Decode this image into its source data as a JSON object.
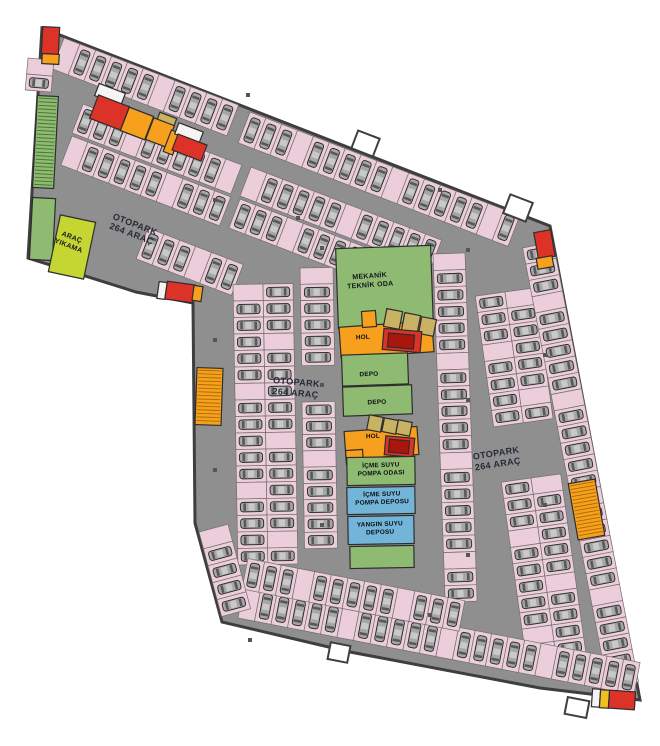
{
  "labels": {
    "otopark_wing": {
      "line1": "OTOPARK",
      "line2": "264 ARAÇ"
    },
    "otopark_left": {
      "line1": "OTOPARK",
      "line2": "264 ARAÇ"
    },
    "otopark_right": {
      "line1": "OTOPARK",
      "line2": "264 ARAÇ"
    },
    "arac_yikama": {
      "line1": "ARAÇ",
      "line2": "YIKAMA"
    },
    "mekanik": {
      "line1": "MEKANİK",
      "line2": "TEKNİK ODA"
    },
    "hol_upper": "HOL",
    "hol_lower": "HOL",
    "depo_1": "DEPO",
    "depo_2": "DEPO",
    "icme_odasi": {
      "line1": "İÇME SUYU",
      "line2": "POMPA ODASI"
    },
    "icme_deposu": {
      "line1": "İÇME SUYU",
      "line2": "POMPA DEPOSU"
    },
    "yangin": {
      "line1": "YANGIN SUYU",
      "line2": "DEPOSU"
    }
  },
  "colors": {
    "floor": "#8f8f8f",
    "outside": "#ffffff",
    "wall": "#3e3e3e",
    "stall": "#eccdda",
    "stall_stroke": "#6f6f6f",
    "car": "#a6a6a6",
    "car_stroke": "#262626",
    "car_glass": "#585858",
    "car_roof": "#c9c9c9",
    "green": "#8eba72",
    "hatch_green": "#47702f",
    "orange": "#f6a01e",
    "hatch_orange": "#a96a00",
    "red": "#dd3227",
    "red_dark": "#a8160e",
    "tan": "#c9b264",
    "blue": "#72b5d8",
    "carwash": "#c5d633",
    "yellow": "#f0c020",
    "white": "#f4f4f4",
    "pillar": "#565656"
  },
  "outline": "42,28 550,226 640,700 540,688 350,652 222,622 195,523 193,303 136,292 28,258",
  "rooms": [
    {
      "n": "stair-core-topleft-red",
      "x": 42,
      "y": 27,
      "w": 17,
      "h": 27,
      "f": "red",
      "r": 3
    },
    {
      "n": "stair-core-topleft-orange",
      "x": 42,
      "y": 54,
      "w": 17,
      "h": 10,
      "f": "orange",
      "r": 3
    },
    {
      "n": "stairs-left-upper",
      "x": 35,
      "y": 96,
      "w": 21,
      "h": 92,
      "f": "green",
      "r": 3,
      "hatch": "g"
    },
    {
      "n": "stairs-left-lower",
      "x": 31,
      "y": 198,
      "w": 23,
      "h": 62,
      "f": "green",
      "r": 3
    },
    {
      "n": "carwash-room",
      "x": 54,
      "y": 218,
      "w": 36,
      "h": 58,
      "f": "carwash",
      "r": 12
    },
    {
      "n": "wing-core-white-a",
      "x": 96,
      "y": 88,
      "w": 28,
      "h": 13,
      "f": "white",
      "r": 21
    },
    {
      "n": "wing-core-red-a",
      "x": 93,
      "y": 100,
      "w": 33,
      "h": 25,
      "f": "red",
      "r": 21
    },
    {
      "n": "wing-core-orange-a",
      "x": 124,
      "y": 111,
      "w": 26,
      "h": 25,
      "f": "orange",
      "r": 21
    },
    {
      "n": "wing-core-tan-a",
      "x": 157,
      "y": 115,
      "w": 18,
      "h": 13,
      "f": "tan",
      "r": 21
    },
    {
      "n": "wing-core-orange-b",
      "x": 149,
      "y": 121,
      "w": 22,
      "h": 23,
      "f": "orange",
      "r": 21
    },
    {
      "n": "wing-core-orange-strip",
      "x": 167,
      "y": 131,
      "w": 10,
      "h": 23,
      "f": "orange",
      "r": 21
    },
    {
      "n": "wing-core-white-b",
      "x": 176,
      "y": 127,
      "w": 26,
      "h": 12,
      "f": "white",
      "r": 21
    },
    {
      "n": "wing-core-red-b",
      "x": 174,
      "y": 139,
      "w": 31,
      "h": 17,
      "f": "red",
      "r": 21
    },
    {
      "n": "stair-core-west-white",
      "x": 158,
      "y": 282,
      "w": 8,
      "h": 17,
      "f": "white",
      "r": 8
    },
    {
      "n": "stair-core-west-red",
      "x": 166,
      "y": 283,
      "w": 28,
      "h": 18,
      "f": "red",
      "r": 8
    },
    {
      "n": "stair-core-west-orange",
      "x": 193,
      "y": 286,
      "w": 9,
      "h": 15,
      "f": "orange",
      "r": 8
    },
    {
      "n": "mekanik-room",
      "x": 337,
      "y": 247,
      "w": 95,
      "h": 80,
      "f": "green",
      "r": -2
    },
    {
      "n": "hol-upper-area",
      "x": 340,
      "y": 324,
      "w": 93,
      "h": 31,
      "f": "orange",
      "r": -4
    },
    {
      "n": "hol-upper-stub",
      "x": 362,
      "y": 311,
      "w": 14,
      "h": 16,
      "f": "orange",
      "r": -4
    },
    {
      "n": "tan-room-1a",
      "x": 385,
      "y": 310,
      "w": 16,
      "h": 18,
      "f": "tan",
      "r": 11
    },
    {
      "n": "tan-room-1b",
      "x": 403,
      "y": 314,
      "w": 16,
      "h": 18,
      "f": "tan",
      "r": 11
    },
    {
      "n": "tan-room-1c",
      "x": 420,
      "y": 318,
      "w": 15,
      "h": 17,
      "f": "tan",
      "r": 11
    },
    {
      "n": "elevator-upper-red",
      "x": 383,
      "y": 330,
      "w": 38,
      "h": 21,
      "f": "red",
      "r": 5
    },
    {
      "n": "elevator-upper-inner",
      "x": 388,
      "y": 334,
      "w": 26,
      "h": 14,
      "f": "red_dark",
      "r": 5
    },
    {
      "n": "depo1-room",
      "x": 342,
      "y": 354,
      "w": 66,
      "h": 31,
      "f": "green",
      "r": -2
    },
    {
      "n": "depo2-room",
      "x": 343,
      "y": 386,
      "w": 69,
      "h": 29,
      "f": "green",
      "r": -2
    },
    {
      "n": "hol-lower-area",
      "x": 345,
      "y": 429,
      "w": 73,
      "h": 28,
      "f": "orange",
      "r": -4
    },
    {
      "n": "hol-lower-stub",
      "x": 346,
      "y": 450,
      "w": 17,
      "h": 14,
      "f": "orange",
      "r": -4
    },
    {
      "n": "tan-room-2a",
      "x": 368,
      "y": 416,
      "w": 14,
      "h": 15,
      "f": "tan",
      "r": 11
    },
    {
      "n": "tan-room-2b",
      "x": 383,
      "y": 419,
      "w": 14,
      "h": 14,
      "f": "tan",
      "r": 11
    },
    {
      "n": "tan-room-2c",
      "x": 397,
      "y": 421,
      "w": 14,
      "h": 14,
      "f": "tan",
      "r": 11
    },
    {
      "n": "elevator-lower-red",
      "x": 385,
      "y": 437,
      "w": 29,
      "h": 19,
      "f": "red",
      "r": 5
    },
    {
      "n": "elevator-lower-inner",
      "x": 389,
      "y": 440,
      "w": 20,
      "h": 13,
      "f": "red_dark",
      "r": 5
    },
    {
      "n": "icme-odasi-room",
      "x": 347,
      "y": 457,
      "w": 68,
      "h": 28,
      "f": "green",
      "r": -1
    },
    {
      "n": "icme-deposu-room",
      "x": 347,
      "y": 487,
      "w": 68,
      "h": 27,
      "f": "blue",
      "r": -1
    },
    {
      "n": "yangin-deposu-room",
      "x": 348,
      "y": 516,
      "w": 66,
      "h": 28,
      "f": "blue",
      "r": -1
    },
    {
      "n": "south-green-room",
      "x": 350,
      "y": 546,
      "w": 64,
      "h": 22,
      "f": "green",
      "r": -1
    },
    {
      "n": "stair-core-topright-red",
      "x": 536,
      "y": 231,
      "w": 17,
      "h": 27,
      "f": "red",
      "r": -10
    },
    {
      "n": "stair-core-topright-orange",
      "x": 537,
      "y": 257,
      "w": 16,
      "h": 11,
      "f": "orange",
      "r": -10
    },
    {
      "n": "ramp-west",
      "x": 196,
      "y": 368,
      "w": 26,
      "h": 57,
      "f": "orange",
      "r": 2,
      "hatch": "o"
    },
    {
      "n": "ramp-east",
      "x": 573,
      "y": 481,
      "w": 27,
      "h": 57,
      "f": "orange",
      "r": -10,
      "hatch": "o"
    },
    {
      "n": "stair-core-bottomright-white",
      "x": 592,
      "y": 689,
      "w": 8,
      "h": 18,
      "f": "white",
      "r": 4
    },
    {
      "n": "stair-core-bottomright-yellow",
      "x": 600,
      "y": 690,
      "w": 9,
      "h": 18,
      "f": "yellow",
      "r": 4
    },
    {
      "n": "stair-core-bottomright-red",
      "x": 609,
      "y": 691,
      "w": 26,
      "h": 18,
      "f": "red",
      "r": 4
    },
    {
      "n": "vent-notch-top-1",
      "x": 354,
      "y": 134,
      "w": 23,
      "h": 19,
      "f": "outside",
      "r": 21,
      "s": "wall"
    },
    {
      "n": "vent-notch-top-2",
      "x": 506,
      "y": 198,
      "w": 24,
      "h": 20,
      "f": "outside",
      "r": 21,
      "s": "wall"
    },
    {
      "n": "vent-notch-bottom-1",
      "x": 329,
      "y": 644,
      "w": 20,
      "h": 17,
      "f": "outside",
      "r": 11,
      "s": "wall"
    },
    {
      "n": "vent-notch-bottom-2",
      "x": 566,
      "y": 699,
      "w": 22,
      "h": 17,
      "f": "outside",
      "r": 11,
      "s": "wall"
    }
  ],
  "parking_rows": [
    {
      "n": "wing-top-row",
      "x": 64,
      "y": 38,
      "a": 21,
      "c": 11,
      "w": 17,
      "d": 33,
      "s": 1
    },
    {
      "n": "wing-mid-row-upper",
      "x": 72,
      "y": 133,
      "a": 21,
      "c": 10,
      "w": 17,
      "d": 31,
      "s": -1
    },
    {
      "n": "wing-mid-row-lower",
      "x": 72,
      "y": 136,
      "a": 21,
      "c": 10,
      "w": 17,
      "d": 31,
      "s": 1
    },
    {
      "n": "wing-bottom-row",
      "x": 148,
      "y": 228,
      "a": 21,
      "c": 6,
      "w": 17,
      "d": 33,
      "s": 1
    },
    {
      "n": "wing-left-row",
      "x": 28,
      "y": 58,
      "a": 95,
      "c": 2,
      "w": 16,
      "d": 26,
      "s": -1
    },
    {
      "n": "north-edge-row",
      "x": 250,
      "y": 112,
      "a": 21,
      "c": 17,
      "w": 17,
      "d": 33,
      "s": 1
    },
    {
      "n": "north-mid-row-upper",
      "x": 240,
      "y": 196,
      "a": 21,
      "c": 12,
      "w": 17,
      "d": 31,
      "s": -1
    },
    {
      "n": "north-mid-row-lower",
      "x": 240,
      "y": 199,
      "a": 21,
      "c": 12,
      "w": 17,
      "d": 31,
      "s": 1
    },
    {
      "n": "west-col-left",
      "x": 263,
      "y": 284,
      "a": 89,
      "c": 17,
      "w": 16.5,
      "d": 30,
      "s": 1
    },
    {
      "n": "west-col-right",
      "x": 263,
      "y": 284,
      "a": 89,
      "c": 17,
      "w": 16.5,
      "d": 30,
      "s": -1
    },
    {
      "n": "west-col2-upper",
      "x": 300,
      "y": 268,
      "a": 89,
      "c": 6,
      "w": 16.3,
      "d": 33,
      "s": -1
    },
    {
      "n": "west-col2-lower",
      "x": 302,
      "y": 402,
      "a": 89,
      "c": 9,
      "w": 16.3,
      "d": 33,
      "s": -1
    },
    {
      "n": "center-col3",
      "x": 433,
      "y": 254,
      "a": 88,
      "c": 21,
      "w": 16.6,
      "d": 32,
      "s": -1
    },
    {
      "n": "east-col-left-upper",
      "x": 505,
      "y": 292,
      "a": 82,
      "c": 8,
      "w": 16.5,
      "d": 30,
      "s": 1
    },
    {
      "n": "east-col-right-upper",
      "x": 505,
      "y": 292,
      "a": 82,
      "c": 8,
      "w": 16.5,
      "d": 30,
      "s": -1
    },
    {
      "n": "east-col-left-lower",
      "x": 531,
      "y": 478,
      "a": 82,
      "c": 11,
      "w": 16.5,
      "d": 30,
      "s": 1
    },
    {
      "n": "east-col-right-lower",
      "x": 531,
      "y": 478,
      "a": 82,
      "c": 11,
      "w": 16.5,
      "d": 30,
      "s": -1
    },
    {
      "n": "east-edge-col",
      "x": 553,
      "y": 242,
      "a": 79,
      "c": 27,
      "w": 16.6,
      "d": 31,
      "s": 1
    },
    {
      "n": "south-edge-row",
      "x": 238,
      "y": 618,
      "a": 11,
      "c": 24,
      "w": 16.8,
      "d": 33,
      "s": -1
    },
    {
      "n": "south-inner-row",
      "x": 242,
      "y": 589,
      "a": 11,
      "c": 13,
      "w": 17,
      "d": 31,
      "s": -1
    },
    {
      "n": "southwest-edge-row",
      "x": 199,
      "y": 532,
      "a": 75,
      "c": 5,
      "w": 17.5,
      "d": 30,
      "s": -1
    }
  ],
  "pillars": [
    [
      215,
      200
    ],
    [
      215,
      340
    ],
    [
      215,
      470
    ],
    [
      248,
      95
    ],
    [
      322,
      248
    ],
    [
      322,
      385
    ],
    [
      322,
      525
    ],
    [
      468,
      250
    ],
    [
      468,
      400
    ],
    [
      468,
      555
    ],
    [
      545,
      355
    ],
    [
      545,
      505
    ],
    [
      250,
      640
    ],
    [
      430,
      615
    ],
    [
      298,
      218
    ],
    [
      440,
      190
    ]
  ]
}
